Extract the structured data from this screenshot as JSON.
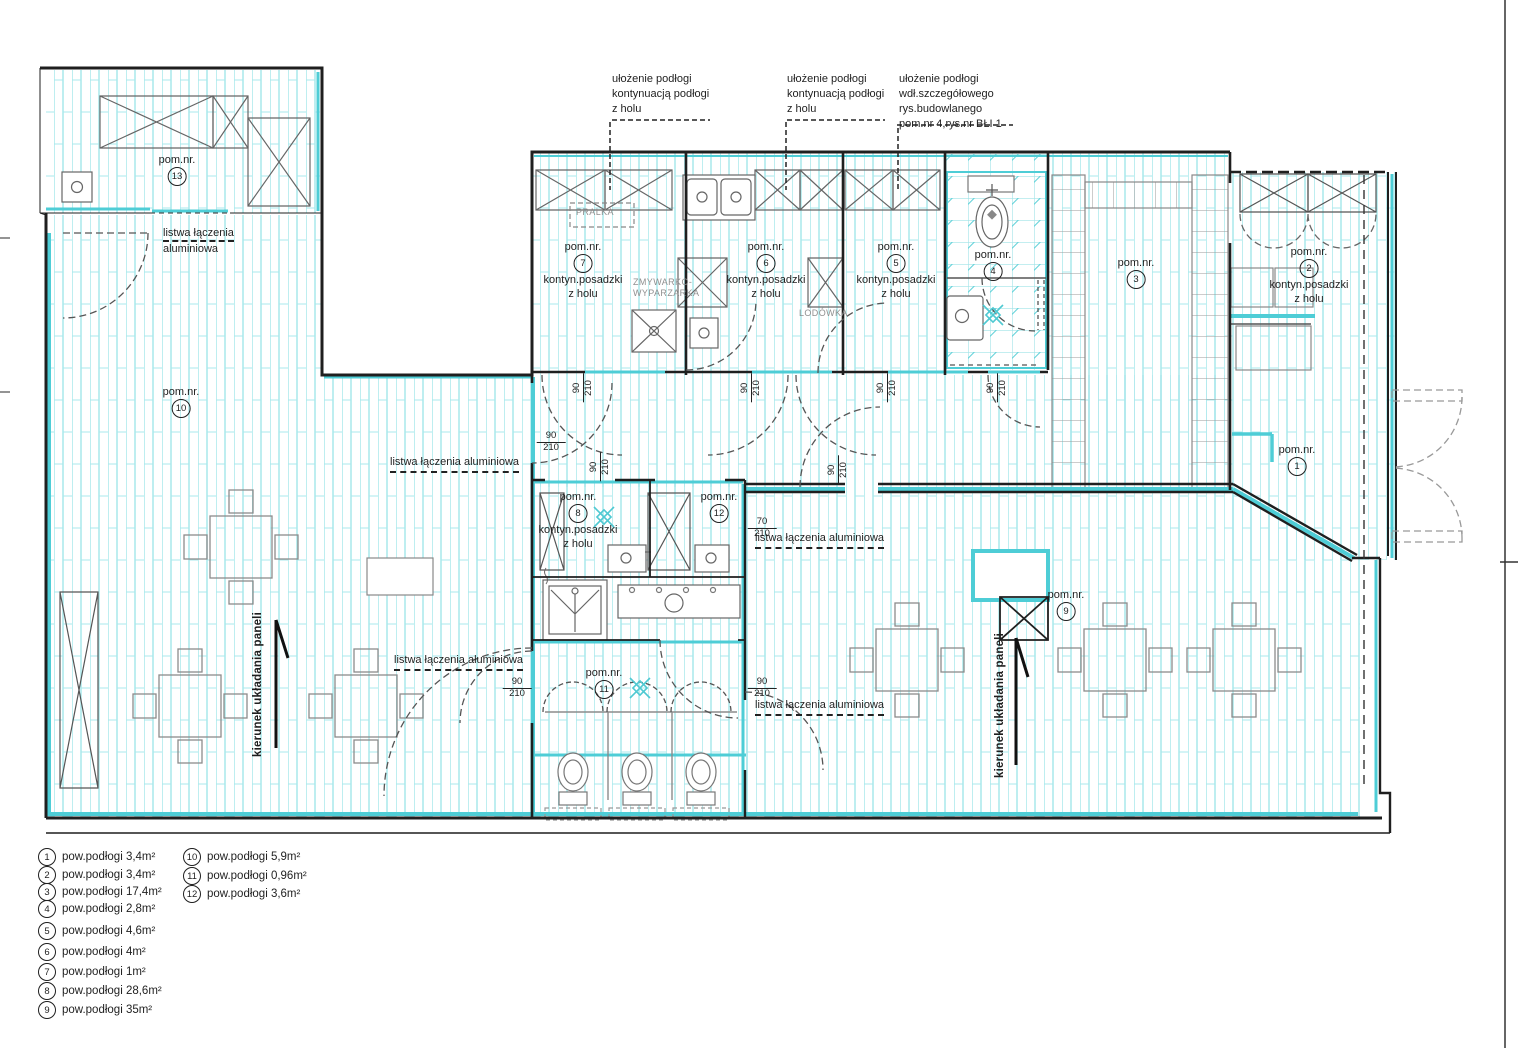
{
  "annotations": {
    "top_note_1": {
      "line1": "ułożenie podłogi",
      "line2": "kontynuacją podłogi",
      "line3": "z holu"
    },
    "top_note_2": {
      "line1": "ułożenie podłogi",
      "line2": "kontynuacją podłogi",
      "line3": "z holu"
    },
    "top_note_3": {
      "line1": "ułożenie podłogi",
      "line2": "wdł.szczegółowego",
      "line3": "rys.budowlanego",
      "line4": "pom.nr 4,rys.nr BŁI 1"
    },
    "listwa_full": "listwa łączenia aluminiowa",
    "listwa_line1": "listwa łączenia",
    "listwa_line2": "aluminiowa",
    "kierunek": "kierunek układania paneli"
  },
  "room_label_prefix": "pom.nr.",
  "rooms": {
    "r1": {
      "num": "1"
    },
    "r2": {
      "num": "2",
      "note1": "kontyn.posadzki",
      "note2": "z holu"
    },
    "r3": {
      "num": "3"
    },
    "r4": {
      "num": "4"
    },
    "r5": {
      "num": "5",
      "note1": "kontyn.posadzki",
      "note2": "z holu"
    },
    "r6": {
      "num": "6",
      "note1": "kontyn.posadzki",
      "note2": "z holu"
    },
    "r7": {
      "num": "7",
      "note1": "kontyn.posadzki",
      "note2": "z holu"
    },
    "r8": {
      "num": "8",
      "note1": "kontyn.posadzki",
      "note2": "z holu"
    },
    "r9": {
      "num": "9"
    },
    "r10": {
      "num": "10"
    },
    "r11": {
      "num": "11"
    },
    "r12": {
      "num": "12"
    },
    "r13": {
      "num": "13"
    }
  },
  "appliances": {
    "pralka": "PRALKA",
    "zmywarko_line1": "ZMYWARKO-",
    "zmywarko_line2": "WYPARZARKA",
    "lodowka": "LODÓWKA"
  },
  "dims": {
    "w90": "90",
    "w70": "70",
    "h210": "210"
  },
  "legend": {
    "items": [
      {
        "num": "1",
        "text": "pow.podłogi 3,4m²"
      },
      {
        "num": "2",
        "text": "pow.podłogi 3,4m²"
      },
      {
        "num": "3",
        "text": "pow.podłogi 17,4m²"
      },
      {
        "num": "4",
        "text": "pow.podłogi 2,8m²"
      },
      {
        "num": "5",
        "text": "pow.podłogi 4,6m²"
      },
      {
        "num": "6",
        "text": "pow.podłogi 4m²"
      },
      {
        "num": "7",
        "text": "pow.podłogi 1m²"
      },
      {
        "num": "8",
        "text": "pow.podłogi 28,6m²"
      },
      {
        "num": "9",
        "text": "pow.podłogi 35m²"
      },
      {
        "num": "10",
        "text": "pow.podłogi 5,9m²"
      },
      {
        "num": "11",
        "text": "pow.podłogi 0,96m²"
      },
      {
        "num": "12",
        "text": "pow.podłogi 3,6m²"
      }
    ]
  },
  "colors": {
    "floor_line": "#a9e8ec",
    "wall_accent": "#4ecdd6",
    "wall_black": "#1f1f1f",
    "furniture_gray": "#8b8b8b",
    "appliance_text": "#8f8f8f"
  }
}
